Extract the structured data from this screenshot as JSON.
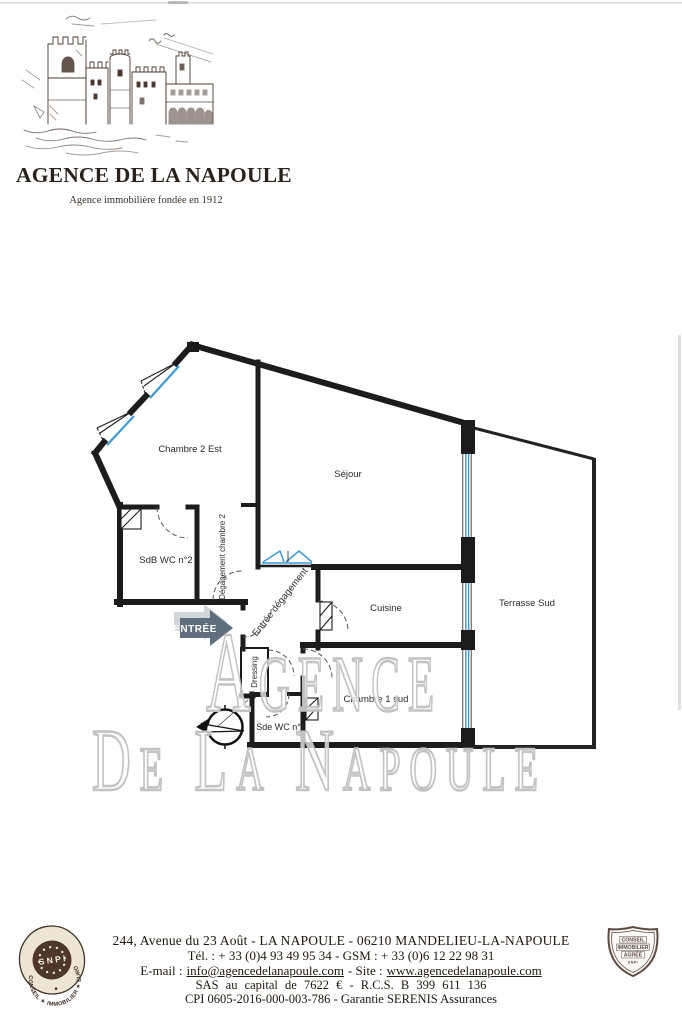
{
  "header": {
    "agency_name": "AGENCE DE LA NAPOULE",
    "tagline": "Agence immobilière fondée en 1912"
  },
  "floorplan": {
    "rooms": [
      {
        "label": "Chambre 2 Est"
      },
      {
        "label": "Séjour"
      },
      {
        "label": "SdB WC n°2"
      },
      {
        "label": "Dégagement chambre 2"
      },
      {
        "label": "Entrée dégagement"
      },
      {
        "label": "Cuisine"
      },
      {
        "label": "Terrasse Sud"
      },
      {
        "label": "Dressing"
      },
      {
        "label": "Sde WC n°1"
      },
      {
        "label": "Chambre 1 sud"
      }
    ],
    "entrance_label": "ENTRÉE",
    "compass_label": "N",
    "colors": {
      "wall": "#1c1c1c",
      "window_glazing": "#3f99d6",
      "entrance_arrow": "#5e6e7d"
    }
  },
  "watermark": {
    "line1": "Agence",
    "line2": "De La Napoule"
  },
  "footer": {
    "address": "244, Avenue du 23 Août - LA NAPOULE - 06210 MANDELIEU-LA-NAPOULE",
    "phone": "Tél. : + 33 (0)4 93 49 95 34 - GSM : + 33 (0)6 12 22 98 31",
    "email_label": "E-mail :",
    "email": "info@agencedelanapoule.com",
    "site_label": "- Site :",
    "site": "www.agencedelanapoule.com",
    "company": "SAS au capital de 7622 € - R.C.S. B 399 611 136",
    "cpi": "CPI 0605-2016-000-003-786 - Garantie SERENIS Assurances",
    "snpi_seal": {
      "ring": "CONSEIL ★ IMMOBILIER ★ EUROPÉEN",
      "center": "S N P I"
    },
    "shield": {
      "line1": "CONSEIL",
      "line2": "IMMOBILIER",
      "line3": "AGRÉÉ",
      "line4": "SNPI"
    }
  }
}
